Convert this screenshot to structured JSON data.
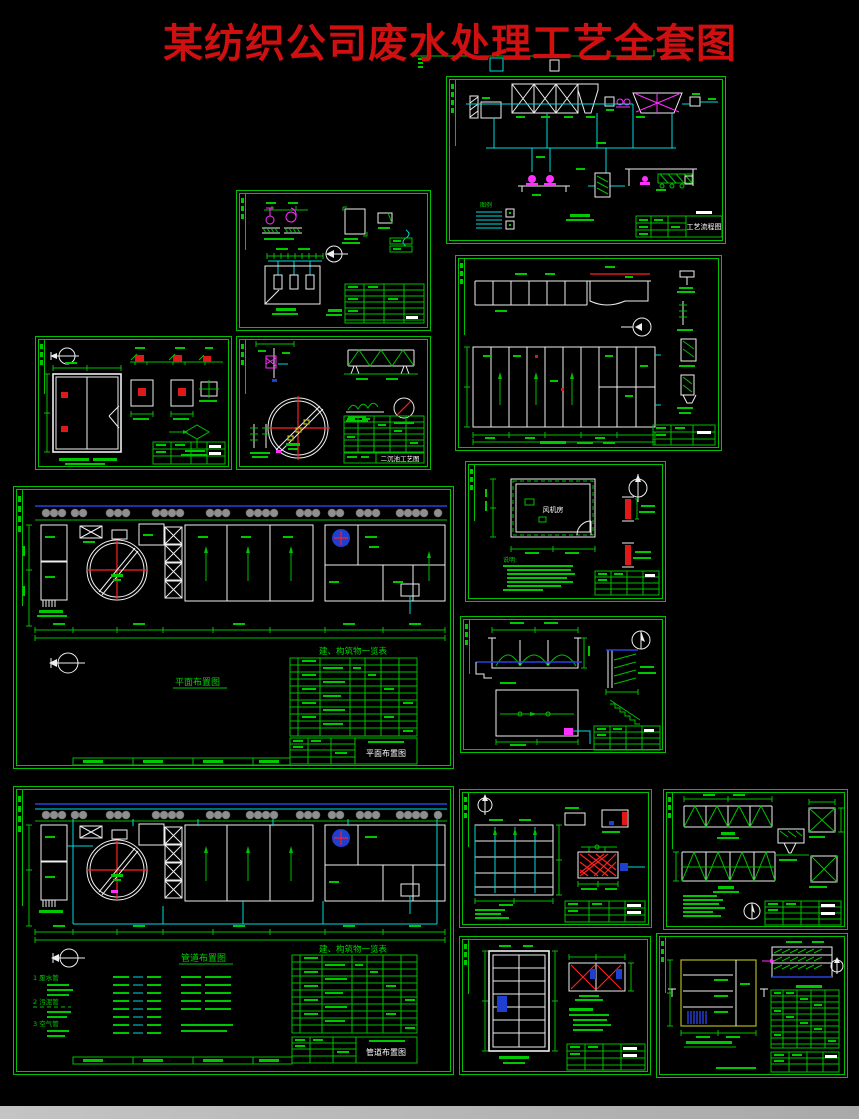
{
  "title": "某纺织公司废水处理工艺全套图",
  "colors": {
    "background": "#000000",
    "title_red": "#d01010",
    "frame_green": "#00c000",
    "annotation_green": "#00d400",
    "line_white": "#efefef",
    "pipe_cyan": "#00dcdc",
    "pump_magenta": "#ff30ff",
    "accent_red": "#ff2020",
    "water_blue": "#2742e0",
    "tank_yellow": "#b2b21a",
    "tree_gray": "#8f8f8f"
  },
  "panels": {
    "process_flow": {
      "title_block_label": "工艺流程图",
      "legend_title": "图例"
    },
    "clarifier_detail": {
      "title_block_label": "二沉池工艺图"
    },
    "plan_layout": {
      "caption": "平面布置图",
      "schedule_title": "建、构筑物一览表",
      "title_block_label": "平面布置图"
    },
    "blower_room": {
      "room_label": "风机房",
      "notes_title": "说明:"
    },
    "piping_layout": {
      "caption": "管道布置图",
      "schedule_title": "建、构筑物一览表",
      "title_block_label": "管道布置图",
      "legend_items": [
        "1 废水管",
        "2 污泥管",
        "3 空气管"
      ]
    }
  }
}
